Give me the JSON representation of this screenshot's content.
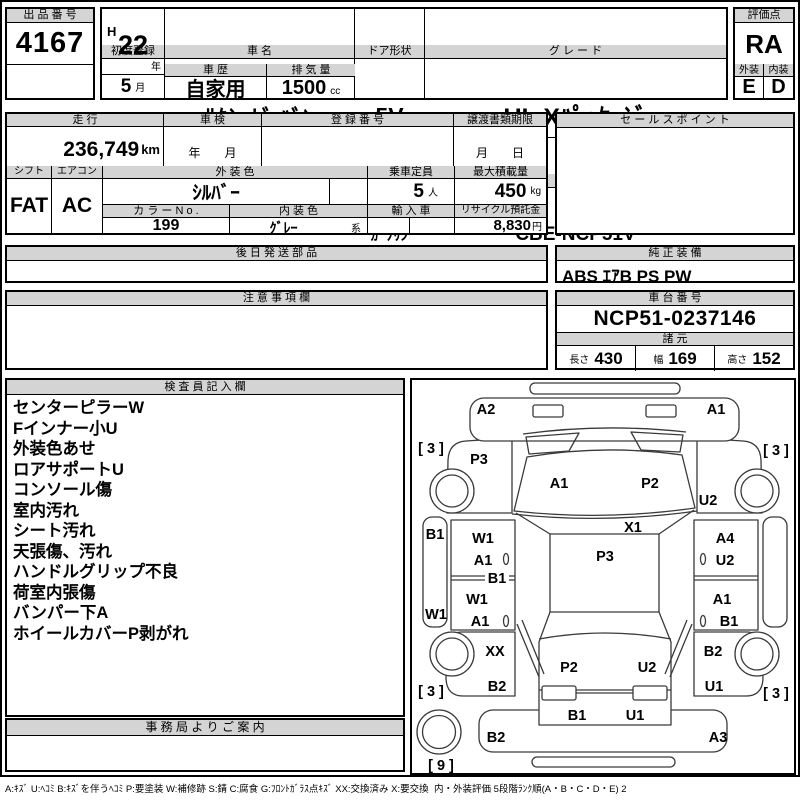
{
  "header": {
    "lot_label": "出 品 番 号",
    "lot_number": "4167",
    "first_reg_label": "初度登録",
    "first_reg_era": "H",
    "first_reg_year": "22",
    "first_reg_year_unit": "年",
    "first_reg_month": "5",
    "first_reg_month_unit": "月",
    "car_name_label": "車 名",
    "car_name": "ｻｸｼｰﾄﾞ ﾊﾞﾝ",
    "door_label": "ドア形状",
    "door": "5V",
    "grade_label": "グ レ ー ド",
    "grade": "UL Xﾊﾟｯｹｰｼﾞ",
    "score_label": "評価点",
    "score": "RA",
    "history_label": "車 歴",
    "history": "自家用",
    "displacement_label": "排 気 量",
    "displacement": "1500",
    "displacement_unit": "cc",
    "fuel_label": "燃 料",
    "fuel": "ｶﾞｿﾘﾝ",
    "model_label": "型 式",
    "model_code": "CBE-NCP51V",
    "exterior_label": "外装",
    "exterior_grade": "E",
    "interior_label": "内装",
    "interior_grade": "D"
  },
  "details": {
    "mileage_label": "走 行",
    "mileage": "236,749",
    "mileage_unit": "km",
    "shaken_label": "車 検",
    "shaken_value": "年　　月",
    "reg_no_label": "登 録 番 号",
    "transfer_label": "譲渡書類期限",
    "transfer_value": "月　　日",
    "sales_point_label": "セ ー ル ス ポ イ ン ト",
    "shift_label": "シフト",
    "shift": "FAT",
    "aircon_label": "エアコン",
    "aircon": "AC",
    "ext_color_label": "外 装 色",
    "ext_color": "ｼﾙﾊﾞｰ",
    "capacity_label": "乗車定員",
    "capacity": "5",
    "capacity_unit": "人",
    "max_load_label": "最大積載量",
    "max_load": "450",
    "max_load_unit": "kg",
    "color_no_label": "カ ラ ー N o .",
    "color_no": "199",
    "int_color_label": "内 装 色",
    "int_color": "ｸﾞﾚｰ",
    "int_color_suffix": "系",
    "import_label": "輸 入 車",
    "recycle_label": "リサイクル預託金",
    "recycle_fee": "8,830",
    "recycle_unit": "円"
  },
  "equipment": {
    "later_parts_label": "後 日 発 送 部 品",
    "factory_label": "純 正 装 備",
    "factory_value": "ABS ｴｱB PS PW",
    "notes_label": "注 意 事 項 欄",
    "chassis_label": "車 台 番 号",
    "chassis_no": "NCP51-0237146",
    "dims_label": "諸 元",
    "length_label": "長さ",
    "length": "430",
    "width_label": "幅",
    "width": "169",
    "height_label": "高さ",
    "height": "152"
  },
  "inspector": {
    "title": "検 査 員 記 入 欄",
    "notes": [
      "センターピラーW",
      "Fインナー小U",
      "外装色あせ",
      "ロアサポートU",
      "コンソール傷",
      "室内汚れ",
      "シート汚れ",
      "天張傷、汚れ",
      "ハンドルグリップ不良",
      "荷室内張傷",
      "バンパー下A",
      "ホイールカバーP剥がれ"
    ]
  },
  "office": {
    "title": "事 務 局 よ り ご 案 内"
  },
  "diagram": {
    "labels": [
      {
        "text": "A2",
        "x": 74,
        "y": 30
      },
      {
        "text": "A1",
        "x": 304,
        "y": 30
      },
      {
        "text": "[ 3 ]",
        "x": 19,
        "y": 69
      },
      {
        "text": "[ 3 ]",
        "x": 364,
        "y": 71
      },
      {
        "text": "P3",
        "x": 67,
        "y": 80
      },
      {
        "text": "A1",
        "x": 147,
        "y": 104
      },
      {
        "text": "P2",
        "x": 238,
        "y": 104
      },
      {
        "text": "U2",
        "x": 296,
        "y": 121
      },
      {
        "text": "B1",
        "x": 23,
        "y": 155
      },
      {
        "text": "W1",
        "x": 71,
        "y": 159
      },
      {
        "text": "X1",
        "x": 221,
        "y": 148
      },
      {
        "text": "A4",
        "x": 313,
        "y": 159
      },
      {
        "text": "A1",
        "x": 71,
        "y": 181
      },
      {
        "text": "P3",
        "x": 193,
        "y": 177
      },
      {
        "text": "U2",
        "x": 313,
        "y": 181
      },
      {
        "text": "B1",
        "x": 85,
        "y": 199
      },
      {
        "text": "W1",
        "x": 65,
        "y": 220
      },
      {
        "text": "A1",
        "x": 310,
        "y": 220
      },
      {
        "text": "W1",
        "x": 24,
        "y": 235
      },
      {
        "text": "A1",
        "x": 68,
        "y": 242
      },
      {
        "text": "B1",
        "x": 317,
        "y": 242
      },
      {
        "text": "XX",
        "x": 83,
        "y": 272
      },
      {
        "text": "B2",
        "x": 301,
        "y": 272
      },
      {
        "text": "P2",
        "x": 157,
        "y": 288
      },
      {
        "text": "U2",
        "x": 235,
        "y": 288
      },
      {
        "text": "B2",
        "x": 85,
        "y": 307
      },
      {
        "text": "U1",
        "x": 302,
        "y": 307
      },
      {
        "text": "[ 3 ]",
        "x": 19,
        "y": 312
      },
      {
        "text": "[ 3 ]",
        "x": 364,
        "y": 314
      },
      {
        "text": "B1",
        "x": 165,
        "y": 336
      },
      {
        "text": "U1",
        "x": 223,
        "y": 336
      },
      {
        "text": "B2",
        "x": 84,
        "y": 358
      },
      {
        "text": "A3",
        "x": 306,
        "y": 358
      },
      {
        "text": "[ 9 ]",
        "x": 29,
        "y": 386
      }
    ]
  },
  "legend": "A:ｷｽﾞ U:ﾍｺﾐ B:ｷｽﾞを伴うﾍｺﾐ P:要塗装 W:補修跡 S:錆 C:腐食 G:ﾌﾛﾝﾄｶﾞﾗｽ点ｷｽﾞ XX:交換済み X:要交換  内・外装評価 5段階ﾗﾝｸ順(A・B・C・D・E) 2"
}
